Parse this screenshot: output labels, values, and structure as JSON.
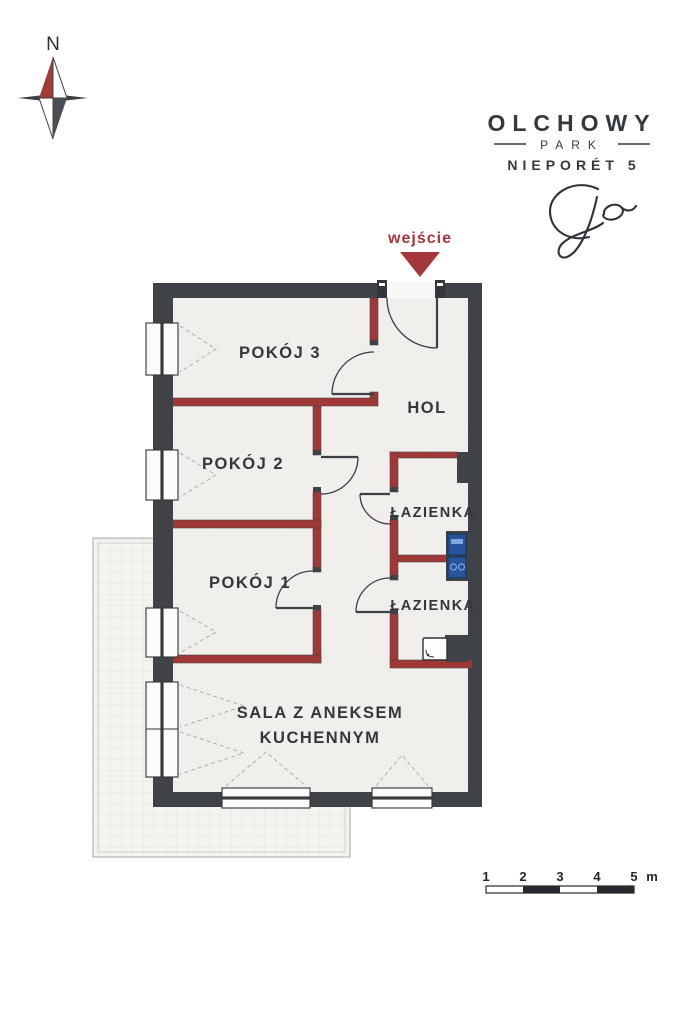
{
  "page": {
    "type": "apartment-floor-plan"
  },
  "compass": {
    "label": "N"
  },
  "logo": {
    "line1": "OLCHOWY",
    "line2": "PARK",
    "line3": "NIEPORÉT 5",
    "monogram_icon": "script-monogram-icon"
  },
  "entrance": {
    "label": "wejście",
    "arrow_icon": "arrow-down-icon"
  },
  "rooms": {
    "pokoj3": "POKÓJ 3",
    "hol": "HOL",
    "pokoj2": "POKÓJ 2",
    "lazienka_upper": "ŁAZIENKA",
    "pokoj1": "POKÓJ 1",
    "lazienka_lower": "ŁAZIENKA",
    "sala_line1": "SALA Z ANEKSEM",
    "sala_line2": "KUCHENNYM"
  },
  "fixtures": {
    "washer_icon": "washer-icon",
    "dryer_icon": "dryer-icon",
    "shower_icon": "shower-icon"
  },
  "scale_bar": {
    "ticks": [
      "1",
      "2",
      "3",
      "4",
      "5"
    ],
    "unit": "m"
  },
  "colors": {
    "exterior_wall": "#3f4247",
    "interior_wall_red": "#9f3836",
    "accent_red": "#a5373c",
    "floor": "#f0efec",
    "terrace": "#f3f3f0",
    "appliance_blue": "#27549c",
    "text_dark": "#33373c"
  }
}
